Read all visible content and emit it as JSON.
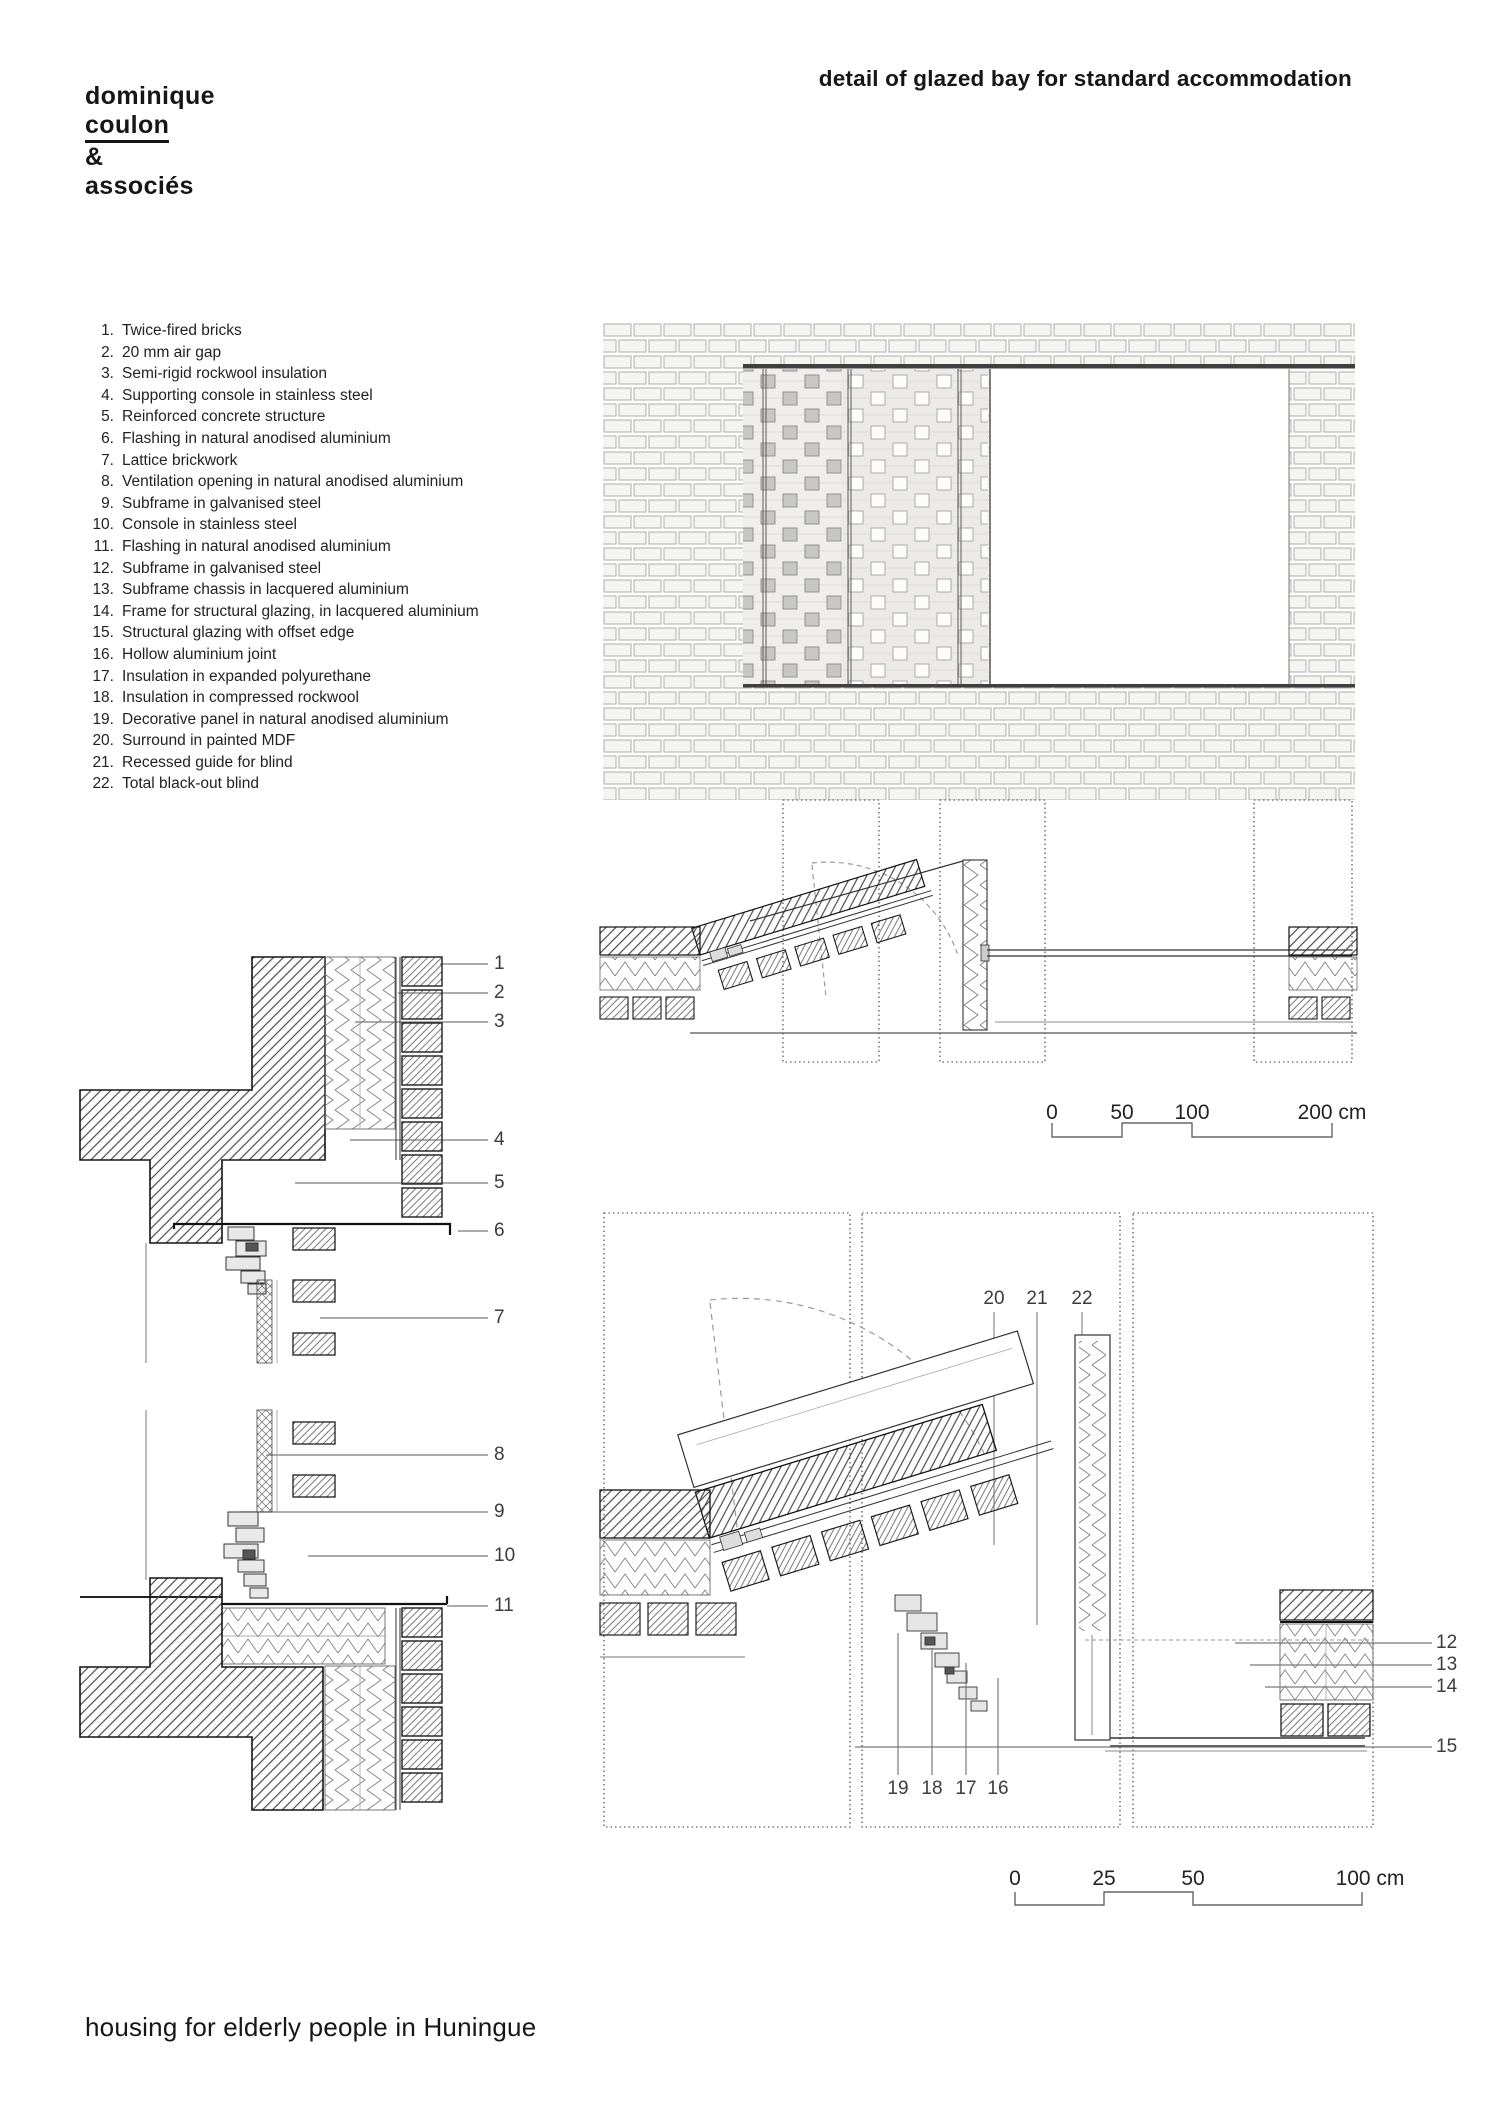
{
  "logo": {
    "line1": "dominique",
    "line2": "coulon",
    "line3": "&",
    "line4": "associés"
  },
  "title": "detail of glazed bay for standard accommodation",
  "footer": "housing for elderly people in Huningue",
  "legend": {
    "items": [
      {
        "n": "1.",
        "label": "Twice-fired bricks"
      },
      {
        "n": "2.",
        "label": "20 mm air gap"
      },
      {
        "n": "3.",
        "label": "Semi-rigid rockwool insulation"
      },
      {
        "n": "4.",
        "label": "Supporting console in stainless steel"
      },
      {
        "n": "5.",
        "label": "Reinforced concrete structure"
      },
      {
        "n": "6.",
        "label": "Flashing in natural anodised aluminium"
      },
      {
        "n": "7.",
        "label": "Lattice brickwork"
      },
      {
        "n": "8.",
        "label": "Ventilation opening in natural anodised aluminium"
      },
      {
        "n": "9.",
        "label": "Subframe in galvanised steel"
      },
      {
        "n": "10.",
        "label": "Console in stainless steel"
      },
      {
        "n": "11.",
        "label": "Flashing in natural anodised aluminium"
      },
      {
        "n": "12.",
        "label": "Subframe in galvanised steel"
      },
      {
        "n": "13.",
        "label": "Subframe chassis in lacquered aluminium"
      },
      {
        "n": "14.",
        "label": "Frame for structural glazing, in lacquered aluminium"
      },
      {
        "n": "15.",
        "label": "Structural glazing with offset edge"
      },
      {
        "n": "16.",
        "label": "Hollow aluminium joint"
      },
      {
        "n": "17.",
        "label": "Insulation in expanded polyurethane"
      },
      {
        "n": "18.",
        "label": "Insulation in compressed rockwool"
      },
      {
        "n": "19.",
        "label": "Decorative panel in natural anodised aluminium"
      },
      {
        "n": "20.",
        "label": "Surround in painted MDF"
      },
      {
        "n": "21.",
        "label": "Recessed guide for blind"
      },
      {
        "n": "22.",
        "label": "Total black-out blind"
      }
    ]
  },
  "callouts": {
    "left": [
      "1",
      "2",
      "3",
      "4",
      "5",
      "6",
      "7",
      "8",
      "9",
      "10",
      "11"
    ],
    "plan_top": [
      "20",
      "21",
      "22"
    ],
    "plan_right": [
      "12",
      "13",
      "14"
    ],
    "glazing_label": "15",
    "plan_bottom": [
      "19",
      "18",
      "17",
      "16"
    ]
  },
  "scale_bar_large": {
    "ticks": [
      "0",
      "50",
      "100",
      "200 cm"
    ]
  },
  "scale_bar_small": {
    "ticks": [
      "0",
      "25",
      "50",
      "100 cm"
    ]
  },
  "colors": {
    "line": "#1a1a1a",
    "leader": "#7a7a7a",
    "lattice_gray": "#c7c7c5",
    "lintel": "#3f3f3f"
  }
}
